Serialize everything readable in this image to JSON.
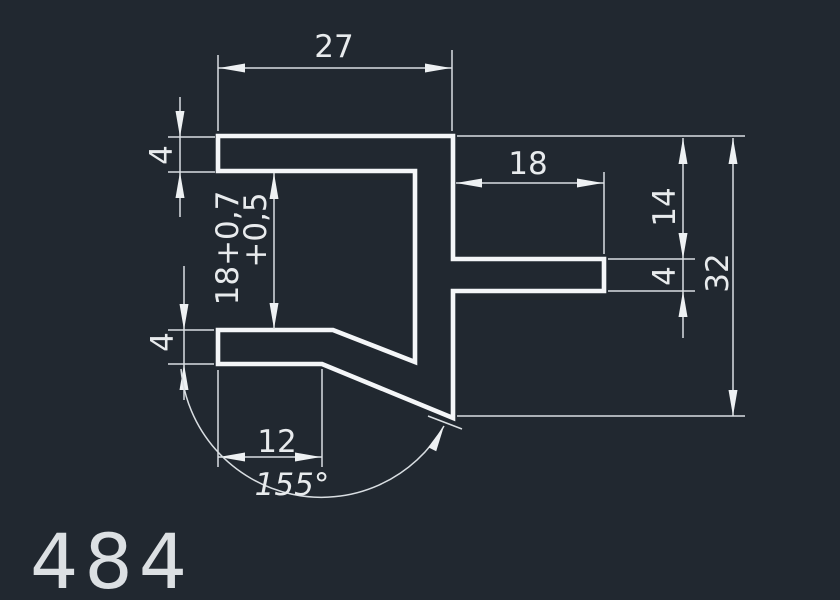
{
  "drawing": {
    "type": "CAD profile cross-section",
    "part_number": "484",
    "colors": {
      "background": "#212830",
      "profile_line": "#f4f6f8",
      "dimension_line": "#d9dee2",
      "text": "#e8ebed"
    },
    "dimensions": {
      "top_width": "27",
      "top_flange_thickness": "4",
      "inner_height": {
        "line1": "18+0,7",
        "line2": "+0,5"
      },
      "arm_length": "18",
      "arm_top_offset": "14",
      "arm_thickness": "4",
      "overall_height": "32",
      "bottom_flange_thickness": "4",
      "bottom_flat_length": "12",
      "bend_angle": "155°"
    }
  }
}
